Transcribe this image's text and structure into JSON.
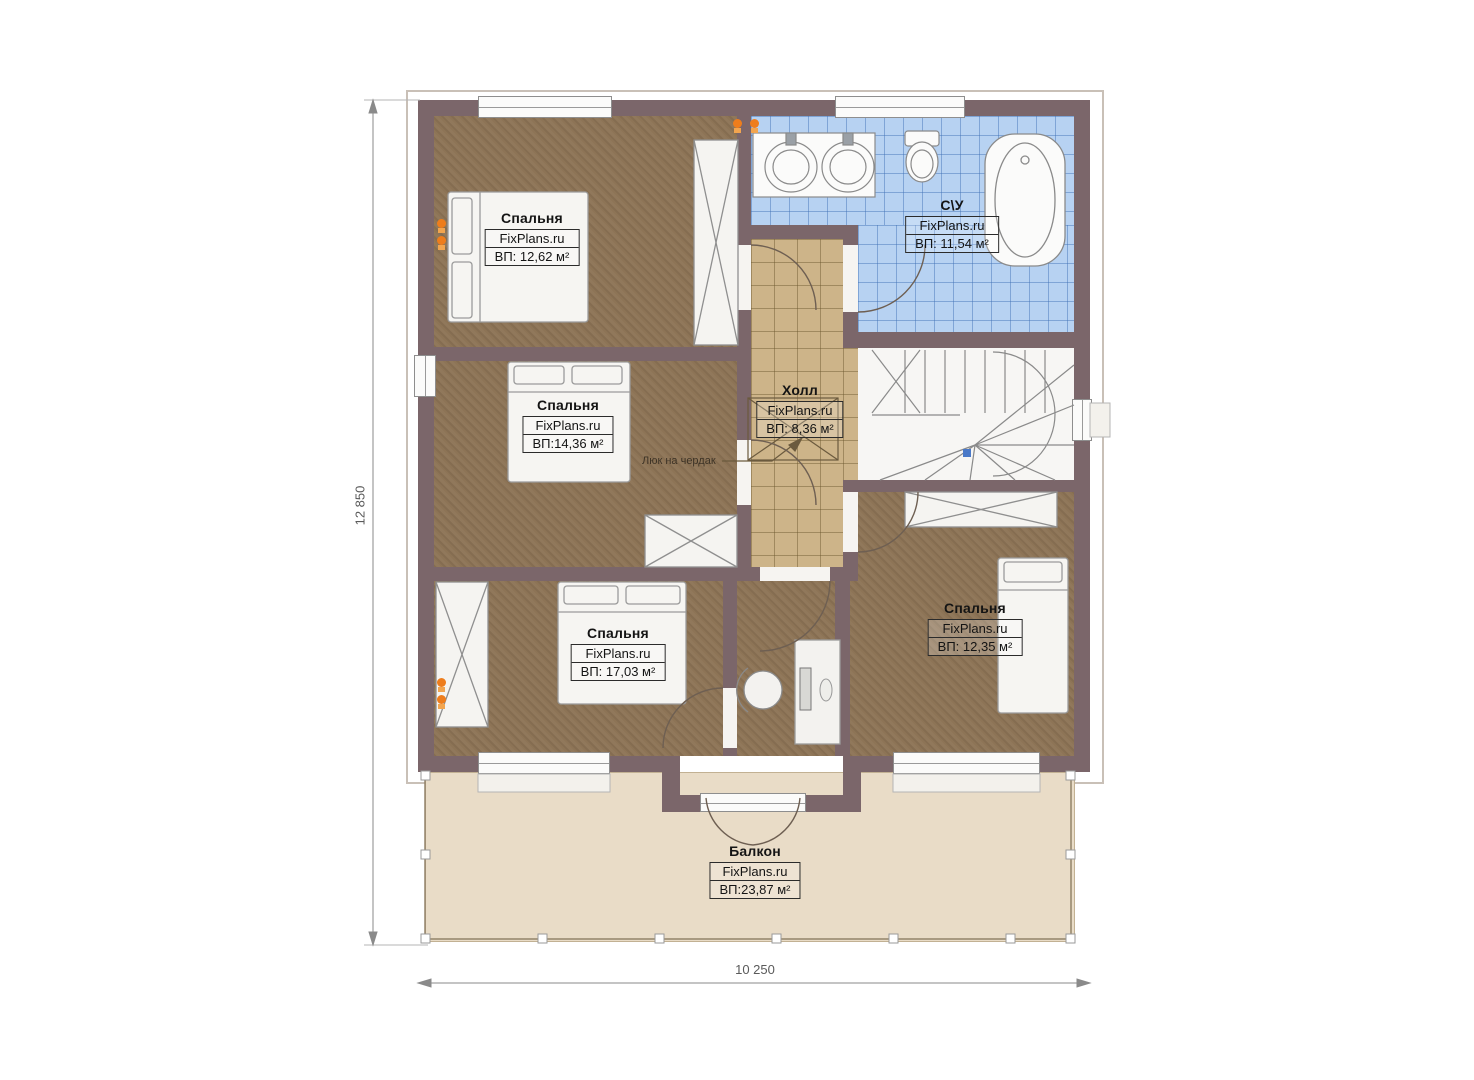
{
  "brand": "FixPlans.ru",
  "rooms": {
    "bedroom1": {
      "name": "Спальня",
      "area": "ВП: 12,62 м²"
    },
    "bathroom": {
      "name": "С\\У",
      "area": "ВП: 11,54 м²"
    },
    "bedroom2": {
      "name": "Спальня",
      "area": "ВП:14,36 м²"
    },
    "hall": {
      "name": "Холл",
      "area": "ВП: 8,36 м²"
    },
    "bedroom3": {
      "name": "Спальня",
      "area": "ВП: 17,03 м²"
    },
    "bedroom4": {
      "name": "Спальня",
      "area": "ВП: 12,35 м²"
    },
    "balcony": {
      "name": "Балкон",
      "area": "ВП:23,87 м²"
    }
  },
  "annotations": {
    "attic_hatch": "Люк на чердак"
  },
  "dimensions": {
    "height_label": "12 850",
    "width_label": "10 250"
  },
  "colors": {
    "wall": "#7b666a",
    "bedroom_floor": "#8d7456",
    "hall_floor": "#cdb489",
    "bathroom_floor": "#b7d2f2",
    "balcony_floor": "#e9dcc7",
    "socket_marker": "#ee7d1c",
    "stair_marker": "#4a79c8"
  }
}
